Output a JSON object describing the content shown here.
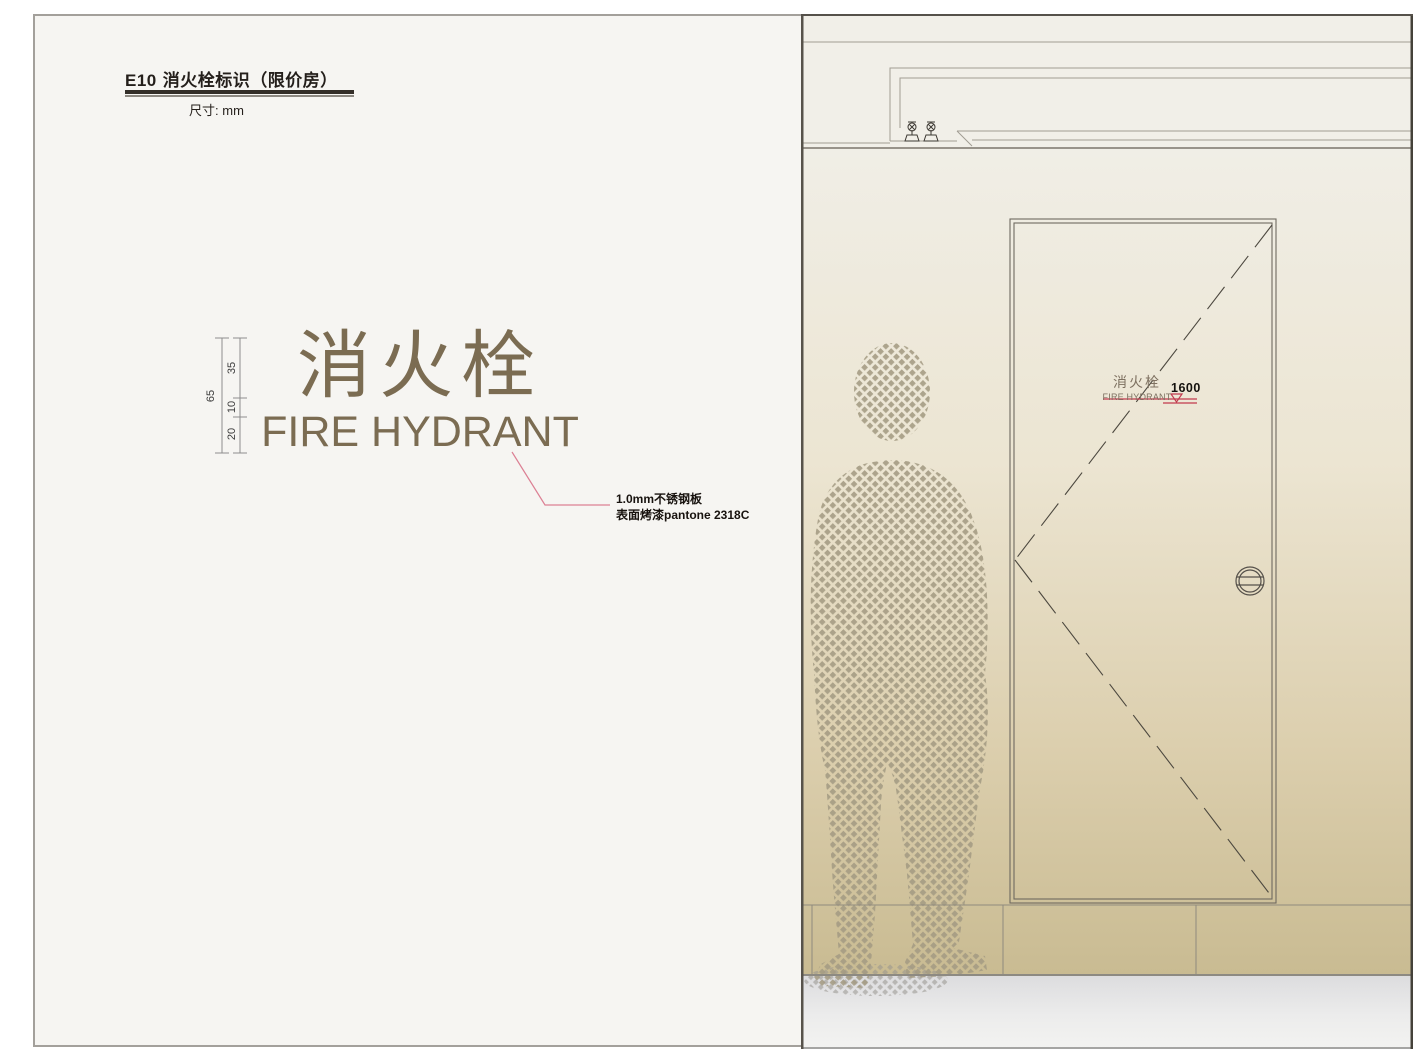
{
  "header": {
    "code": "E10",
    "title": "消火栓标识（限价房）",
    "unit_label": "尺寸: mm"
  },
  "sign": {
    "cn": "消火栓",
    "en": "FIRE HYDRANT",
    "color": "#7b6c52",
    "dimensions": {
      "total": "65",
      "cn_height": "35",
      "gap": "10",
      "en_height": "20"
    },
    "annotation": {
      "line1": "1.0mm不锈钢板",
      "line2": "表面烤漆pantone 2318C"
    }
  },
  "elevation": {
    "door_sign_cn": "消火栓",
    "door_sign_en": "FIRE HYDRANT",
    "mounting_height": "1600",
    "marker_color": "#c23a4e"
  },
  "colors": {
    "page_bg": "#f6f5f2",
    "sign_text": "#7b6c52",
    "leader_pink": "#dc8094",
    "wall_top": "#f0eee6",
    "wall_bottom": "#c9bb92",
    "halftone_dot": "#a49b83"
  }
}
